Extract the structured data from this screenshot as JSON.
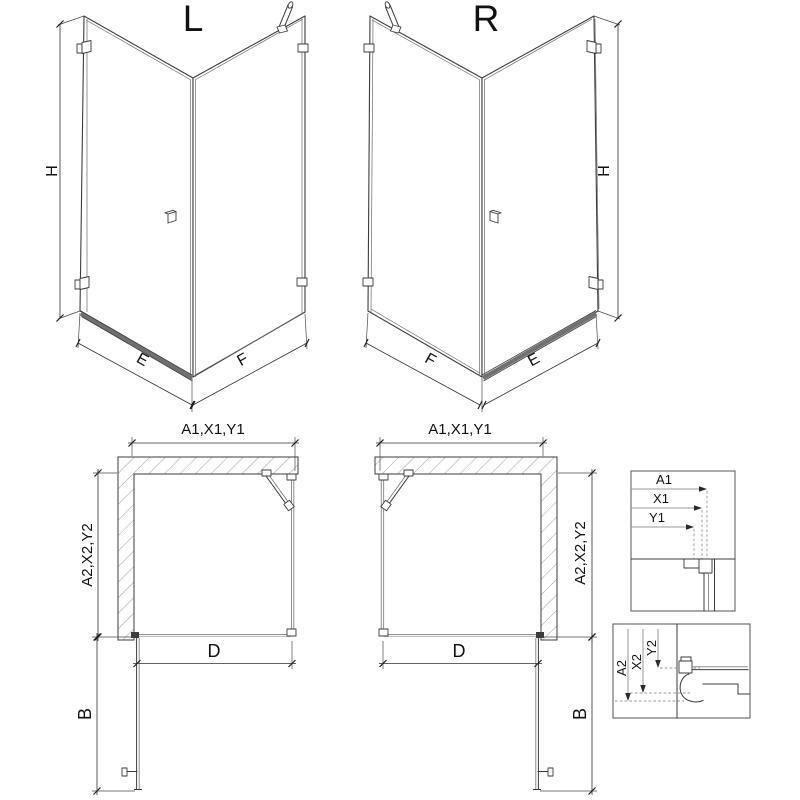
{
  "colors": {
    "line": "#3c3c3c",
    "glass_edge": "#8f8f8f",
    "dimension": "#2f2f2f",
    "dashed_guide": "#999999",
    "threshold": "#707070",
    "background": "#ffffff"
  },
  "iso_left": {
    "label": "L",
    "height_dim": "H",
    "door_width_dim": "E",
    "fixed_width_dim": "F"
  },
  "iso_right": {
    "label": "R",
    "height_dim": "H",
    "fixed_width_dim": "F",
    "door_width_dim": "E"
  },
  "plan_left": {
    "width_dim": "A1,X1,Y1",
    "depth_dim": "A2,X2,Y2",
    "door_dim": "D",
    "swing_dim": "B"
  },
  "plan_right": {
    "width_dim": "A1,X1,Y1",
    "depth_dim": "A2,X2,Y2",
    "door_dim": "D",
    "swing_dim": "B"
  },
  "detail_wall_profile": {
    "dims": [
      "A1",
      "X1",
      "Y1"
    ]
  },
  "detail_tray_profile": {
    "dims": [
      "A2",
      "X2",
      "Y2"
    ]
  }
}
